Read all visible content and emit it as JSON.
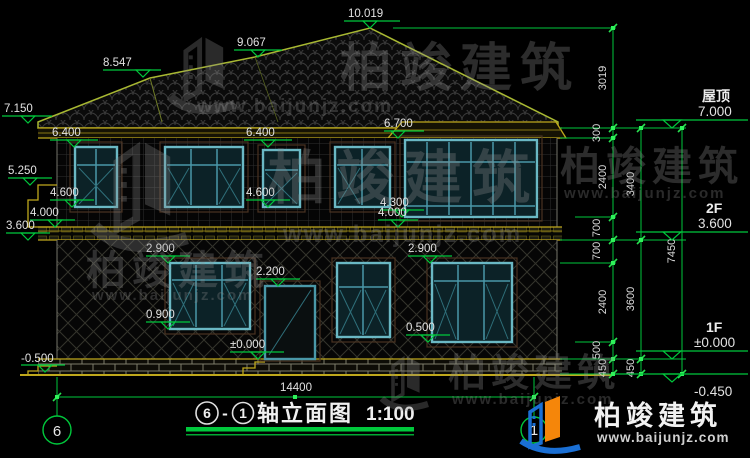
{
  "drawing": {
    "title": {
      "bubble_left": "6",
      "dash": "-",
      "bubble_right": "1",
      "name": "轴立面图",
      "scale": "1:100"
    },
    "axis_bubbles": {
      "left": "6",
      "right": "1"
    },
    "overall_width_dim": "14400",
    "elevation_labels": {
      "peak": "10.019",
      "ridge_left": "9.067",
      "ridge_lower": "8.547",
      "eave_left": "7.150",
      "w2f_left_top": "6.400",
      "w2f_mid_top": "6.400",
      "bay_top": "6.700",
      "step_top": "5.250",
      "w2f_left_sill": "4.600",
      "w2f_mid_sill": "4.600",
      "bay_sill": "4.300",
      "band_left": "4.000",
      "band_right": "4.000",
      "floor2_left": "3.600",
      "w1f_left_top": "2.900",
      "w1f_right_top": "2.900",
      "door_top": "2.200",
      "w1f_left_sill": "0.900",
      "w1f_right_sill": "0.500",
      "ground_floor": "±0.000",
      "grade_left": "-0.500"
    },
    "right_levels": [
      {
        "name": "屋顶",
        "elev": "7.000"
      },
      {
        "name": "2F",
        "elev": "3.600"
      },
      {
        "name": "1F",
        "elev": "±0.000"
      },
      {
        "name": "",
        "elev": "-0.450"
      }
    ],
    "vertical_dims": {
      "chain_inner": [
        "3019",
        "300",
        "2400",
        "700",
        "700",
        "2400",
        "500",
        "450"
      ],
      "chain_middle": [
        "3400",
        "3600",
        "450"
      ],
      "chain_outer": [
        "7450"
      ]
    }
  },
  "watermark": {
    "company": "柏竣建筑",
    "website": "www.baijunjz.com"
  },
  "colors": {
    "dimension_green": "#00c83c",
    "fascia_yellow": "#bfa81c",
    "window_teal": "#6ab8c4",
    "logo_blue": "#1a6fd4",
    "logo_orange": "#f5860a"
  }
}
